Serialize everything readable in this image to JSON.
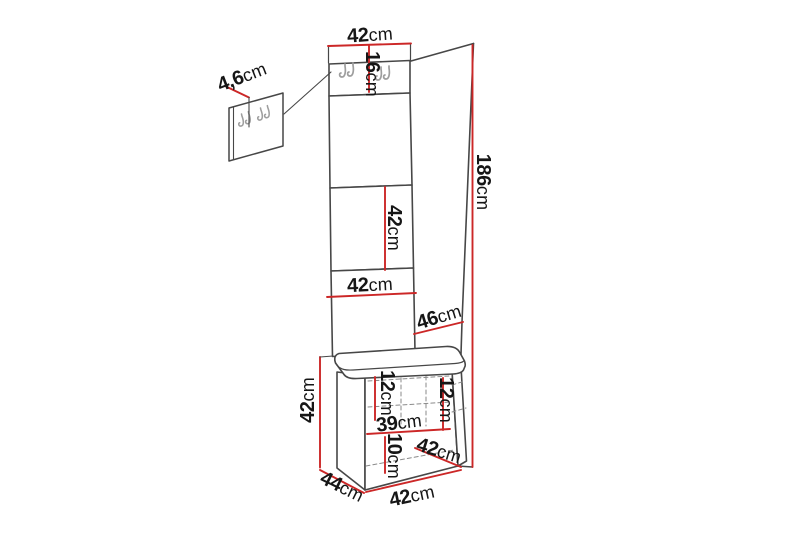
{
  "page": {
    "type": "furniture-dimension-diagram",
    "background": "#ffffff"
  },
  "colors": {
    "outline": "#474747",
    "dimension_line": "#cc2727",
    "hook": "#9e9e9e",
    "text": "#161616",
    "hidden_line": "#8a8a8a"
  },
  "icons": {
    "coat_hook": "coat-hook-icon"
  },
  "dimensions": {
    "top_width": {
      "value": "42",
      "unit": "cm"
    },
    "hook_panel_height": {
      "value": "16",
      "unit": "cm"
    },
    "wall_panel_depth": {
      "value": "4,6",
      "unit": "cm"
    },
    "upper_panel_height": {
      "value": "42",
      "unit": "cm"
    },
    "total_height": {
      "value": "186",
      "unit": "cm"
    },
    "panel_width": {
      "value": "42",
      "unit": "cm"
    },
    "side_depth": {
      "value": "46",
      "unit": "cm"
    },
    "bench_height": {
      "value": "42",
      "unit": "cm"
    },
    "drawer_left_height": {
      "value": "12",
      "unit": "cm"
    },
    "drawer_right_height": {
      "value": "12",
      "unit": "cm"
    },
    "inner_width": {
      "value": "39",
      "unit": "cm"
    },
    "base_height": {
      "value": "10",
      "unit": "cm"
    },
    "seat_depth": {
      "value": "42",
      "unit": "cm"
    },
    "bench_depth": {
      "value": "44",
      "unit": "cm"
    },
    "bench_width": {
      "value": "42",
      "unit": "cm"
    }
  }
}
